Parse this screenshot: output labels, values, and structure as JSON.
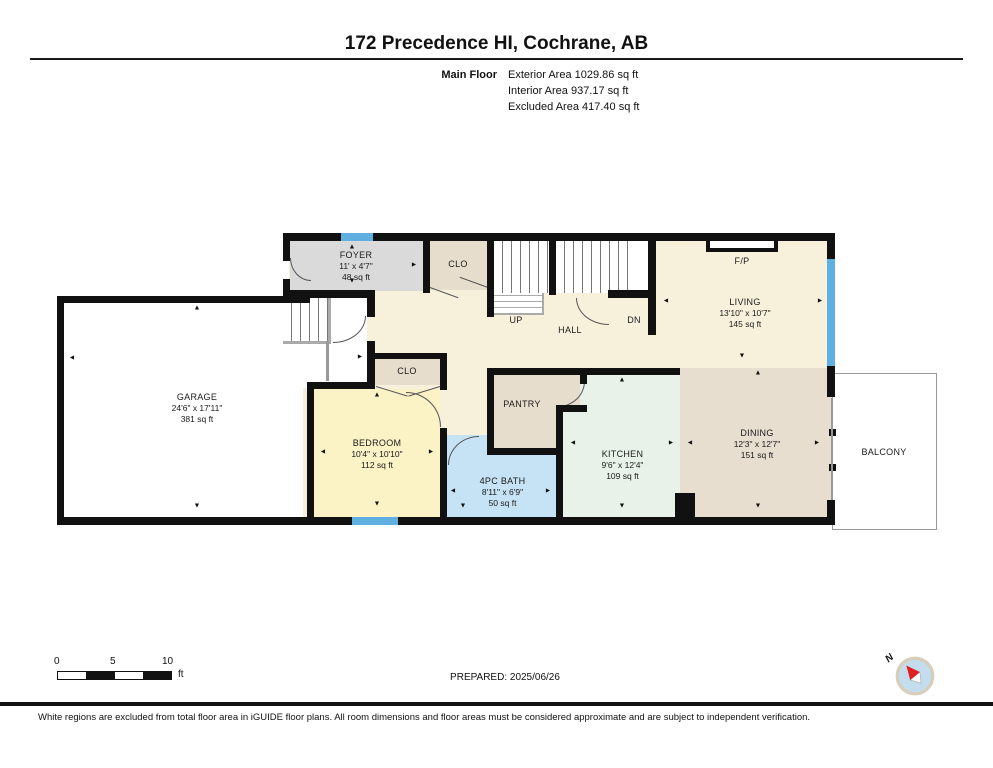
{
  "header": {
    "title": "172 Precedence HI, Cochrane, AB",
    "floor_label": "Main Floor",
    "area_lines": [
      "Exterior Area 1029.86 sq ft",
      "Interior Area 937.17 sq ft",
      "Excluded Area 417.40 sq ft"
    ]
  },
  "rooms": {
    "garage": {
      "name": "GARAGE",
      "dims": "24'6\" x 17'11\"",
      "area": "381 sq ft"
    },
    "foyer": {
      "name": "FOYER",
      "dims": "11' x 4'7\"",
      "area": "48 sq ft"
    },
    "living": {
      "name": "LIVING",
      "dims": "13'10\" x 10'7\"",
      "area": "145 sq ft"
    },
    "bedroom": {
      "name": "BEDROOM",
      "dims": "10'4\" x 10'10\"",
      "area": "112 sq ft"
    },
    "bath": {
      "name": "4PC BATH",
      "dims": "8'11\" x 6'9\"",
      "area": "50 sq ft"
    },
    "kitchen": {
      "name": "KITCHEN",
      "dims": "9'6\" x 12'4\"",
      "area": "109 sq ft"
    },
    "dining": {
      "name": "DINING",
      "dims": "12'3\" x 12'7\"",
      "area": "151 sq ft"
    },
    "foyer_closet": {
      "name": "CLO"
    },
    "bedroom_closet": {
      "name": "CLO"
    },
    "pantry": {
      "name": "PANTRY"
    },
    "hall": {
      "name": "HALL"
    },
    "balcony": {
      "name": "BALCONY"
    },
    "fireplace": {
      "name": "F/P"
    },
    "stairs_up": {
      "name": "UP"
    },
    "stairs_down": {
      "name": "DN"
    }
  },
  "footer": {
    "scale": {
      "labels": [
        "0",
        "5",
        "10"
      ],
      "unit": "ft"
    },
    "prepared": "PREPARED: 2025/06/26",
    "compass_north": "N",
    "disclaimer": "White regions are excluded from total floor area in iGUIDE floor plans. All room dimensions and floor areas must be considered approximate and are subject to independent verification."
  },
  "glyphs": {
    "up": "▲",
    "down": "▼",
    "left": "◄",
    "right": "►"
  },
  "colors": {
    "wall": "#111111",
    "window": "#5FAFE0",
    "hall_floor": "#F7F1DC",
    "foyer_floor": "#DADADA",
    "closet_floor": "#E6DDCD",
    "bedroom_floor": "#FBF2C6",
    "bath_floor": "#C5E3F5",
    "kitchen_floor": "#E9F2E9",
    "dining_floor": "#E7DED0",
    "compass_red": "#E02020",
    "compass_blue": "#C3DDEF"
  }
}
